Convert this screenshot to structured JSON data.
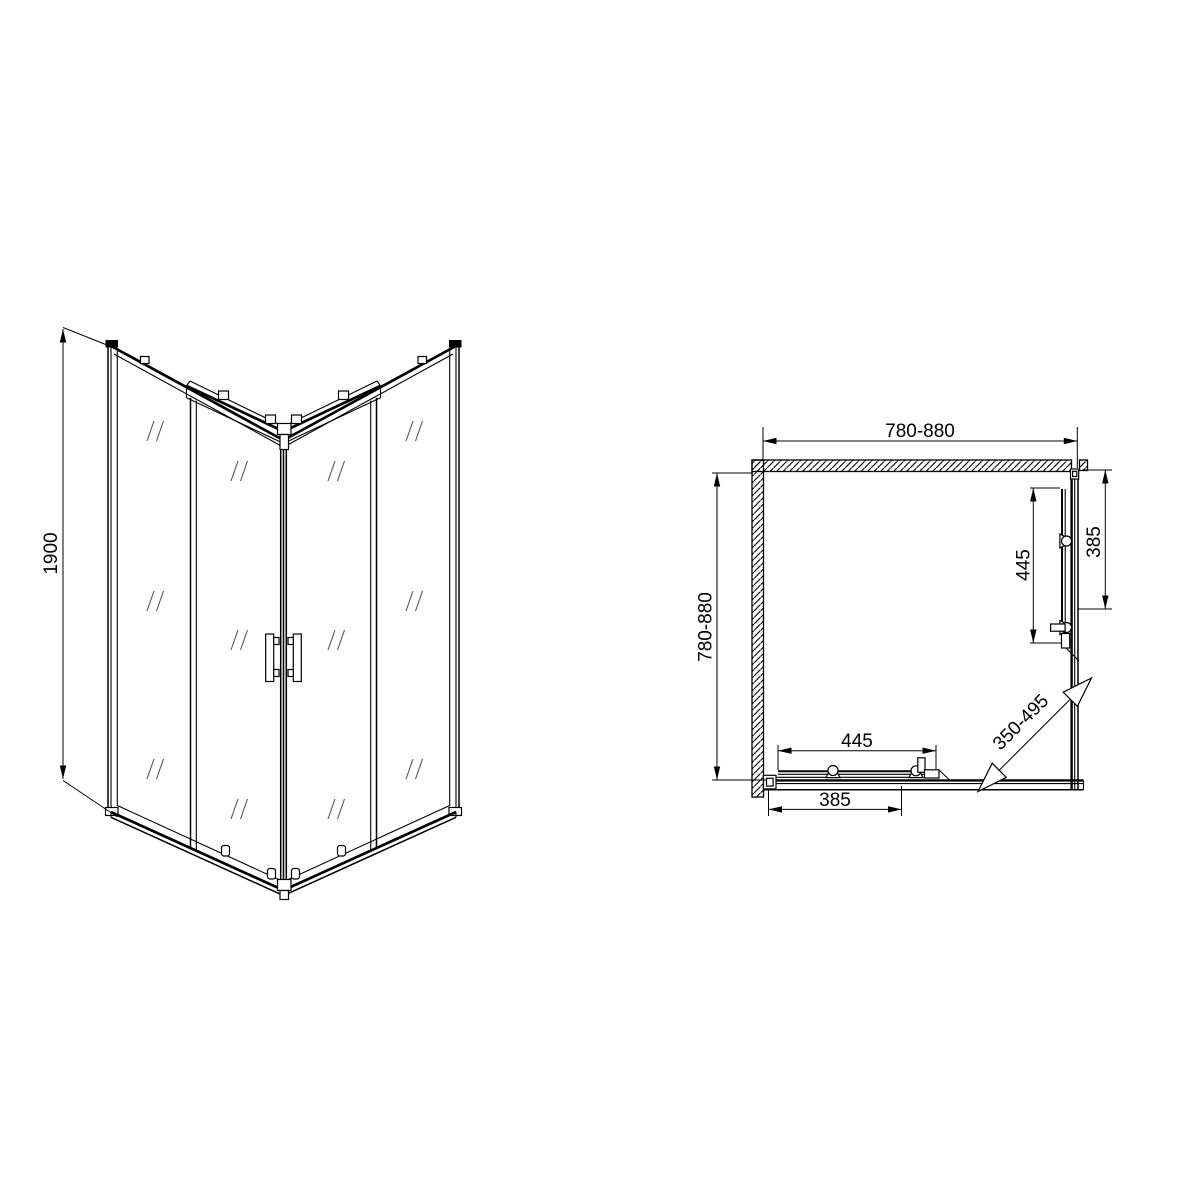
{
  "page": {
    "background": "#ffffff",
    "line_color": "#000000"
  },
  "front_view": {
    "dimensions": {
      "height": {
        "label": "1900"
      }
    }
  },
  "plan_view": {
    "dimensions": {
      "top_width": {
        "label": "780-880"
      },
      "left_depth": {
        "label": "780-880"
      },
      "bottom_fixed_panel": {
        "label": "445"
      },
      "bottom_door": {
        "label": "385"
      },
      "right_fixed_panel": {
        "label": "445"
      },
      "right_door": {
        "label": "385"
      },
      "diagonal_entry": {
        "label": "350-495"
      }
    }
  }
}
